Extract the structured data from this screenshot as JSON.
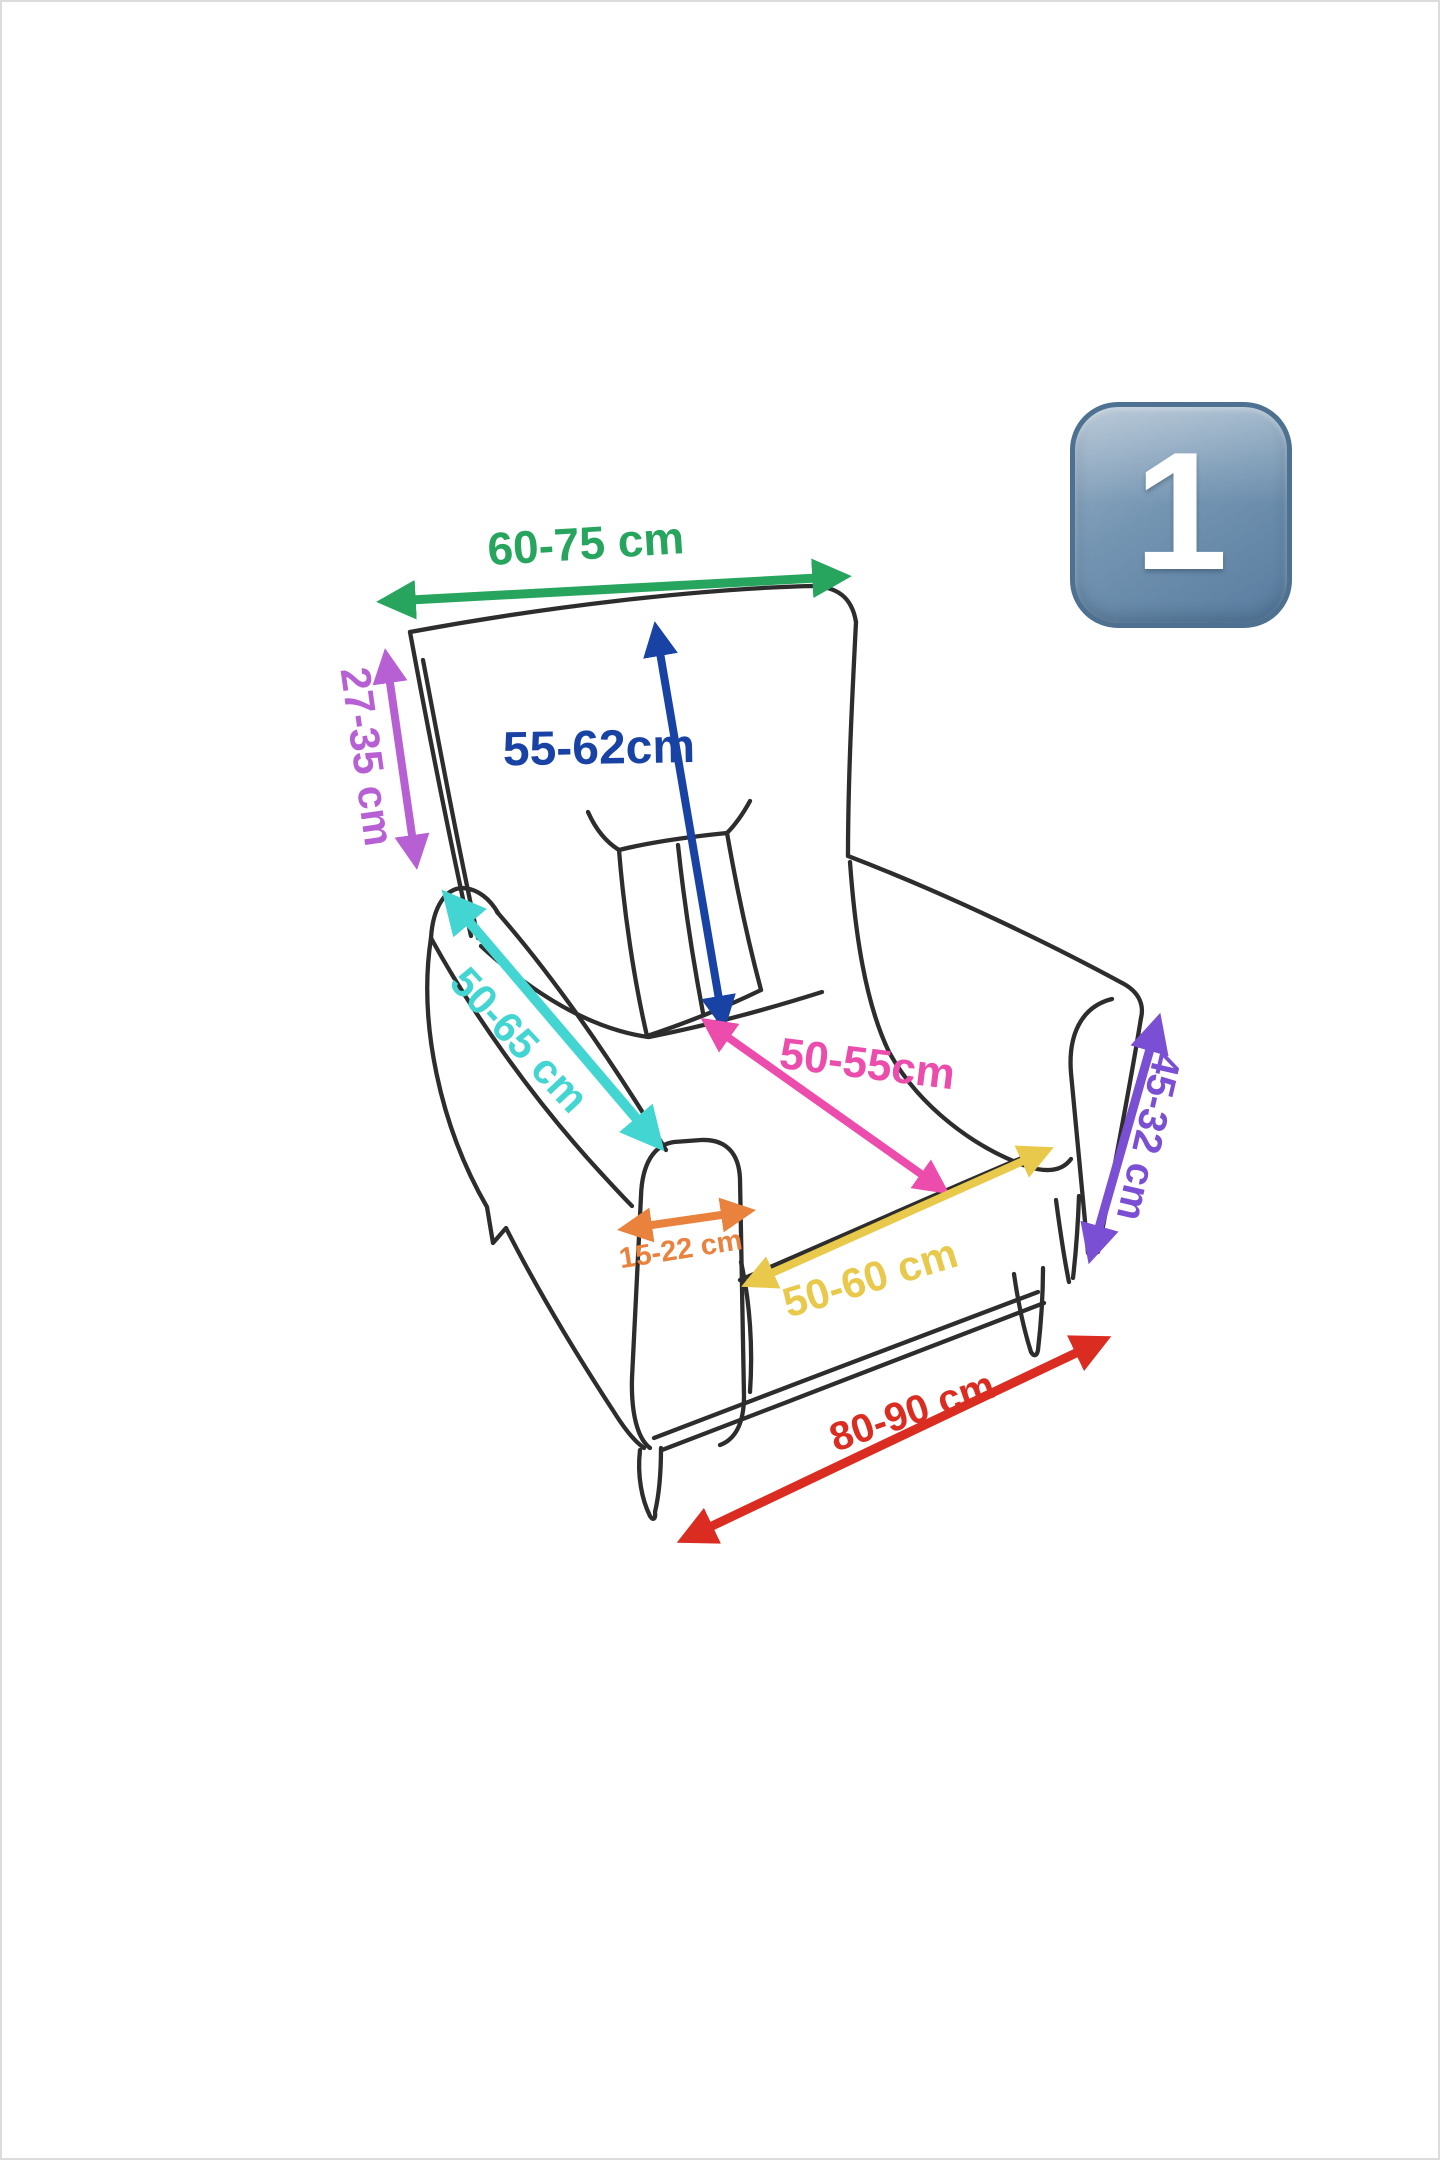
{
  "page": {
    "background": "#ffffff",
    "frame_color": "#dcdcdc"
  },
  "badge": {
    "digit": "1",
    "shape": "rounded-square-keycap",
    "fill_light": "#9db3c8",
    "fill_dark": "#587b9e",
    "border_color": "#4e7191",
    "digit_color": "#ffffff"
  },
  "diagram": {
    "subject": "armchair-dimensions-sketch",
    "sketch_color": "#2d2d2d",
    "measurements": [
      {
        "id": "top-width",
        "label": "60-75 cm",
        "color": "#27a55e"
      },
      {
        "id": "back-height",
        "label": "27-35 cm",
        "color": "#b760d3"
      },
      {
        "id": "backrest-diagonal",
        "label": "55-62cm",
        "color": "#1843a4"
      },
      {
        "id": "armrest-length",
        "label": "50-65 cm",
        "color": "#42d5d2"
      },
      {
        "id": "seat-depth",
        "label": "50-55cm",
        "color": "#ec4dac"
      },
      {
        "id": "armrest-width",
        "label": "15-22 cm",
        "color": "#e8823c"
      },
      {
        "id": "seat-width",
        "label": "50-60 cm",
        "color": "#e9c94b"
      },
      {
        "id": "arm-height",
        "label": "45-32 cm",
        "color": "#7b4fd4"
      },
      {
        "id": "base-width",
        "label": "80-90 cm",
        "color": "#da2c20"
      }
    ]
  }
}
